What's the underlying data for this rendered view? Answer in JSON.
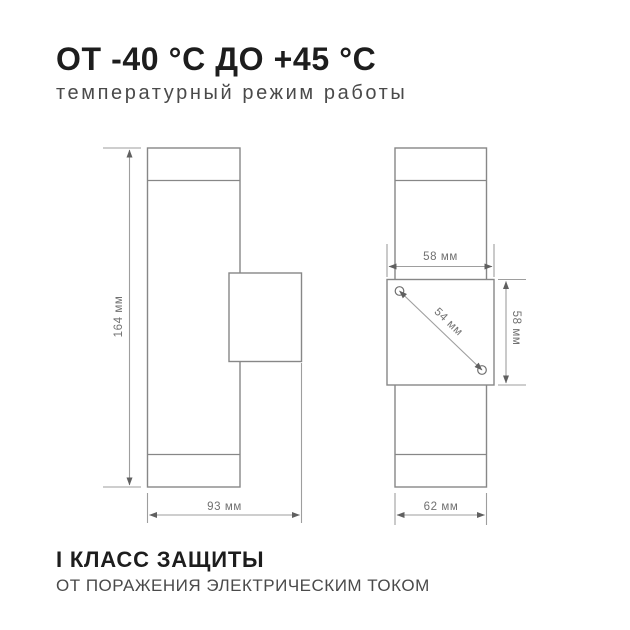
{
  "header": {
    "title": "ОТ -40 °C ДО +45 °C",
    "subtitle": "температурный режим работы"
  },
  "footer": {
    "title": "I КЛАСС ЗАЩИТЫ",
    "subtitle": "ОТ ПОРАЖЕНИЯ ЭЛЕКТРИЧЕСКИМ ТОКОМ"
  },
  "diagram": {
    "side_view": {
      "height_label": "164 мм",
      "depth_label": "93 мм"
    },
    "front_view": {
      "plate_width_label": "58 мм",
      "plate_height_label": "58 мм",
      "hole_spacing_label": "54 мм",
      "body_width_label": "62 мм"
    },
    "colors": {
      "title_text": "#1d1d1d",
      "secondary_text": "#4a4a4a",
      "drawing_line": "#878787",
      "dimension_line": "#9e9e9e",
      "dimension_text": "#707070"
    }
  }
}
